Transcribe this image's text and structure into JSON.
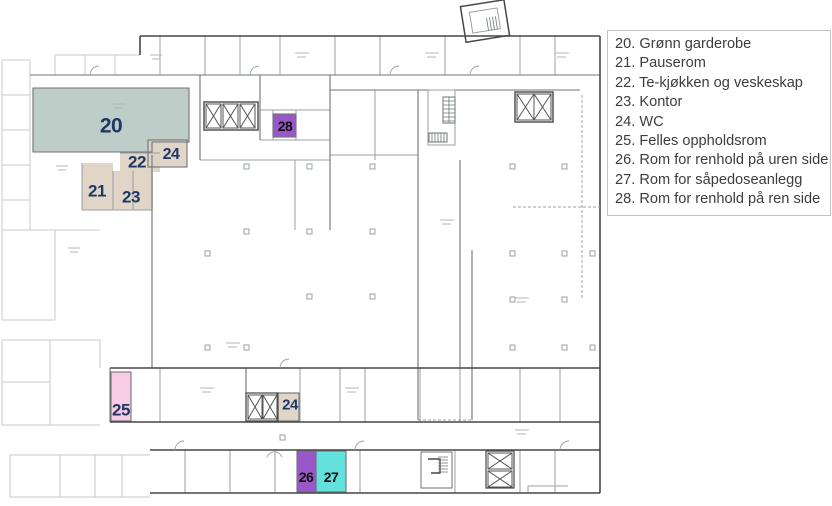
{
  "legend": {
    "items": [
      "20. Grønn garderobe",
      "21. Pauserom",
      "22. Te-kjøkken og veskeskap",
      "23. Kontor",
      "24. WC",
      "25. Felles oppholdsrom",
      "26. Rom for renhold på uren side",
      "27. Rom for såpedoseanlegg",
      "28. Rom for renhold på ren side"
    ]
  },
  "rooms": [
    {
      "number": "20",
      "name": "Grønn garderobe",
      "fill": "#b9c9c2",
      "text": "#1f3864"
    },
    {
      "number": "21",
      "name": "Pauserom",
      "fill": "#ddd1c2",
      "text": "#1f3864"
    },
    {
      "number": "22",
      "name": "Te-kjøkken og veskeskap",
      "fill": "#ddd1c2",
      "text": "#1f3864"
    },
    {
      "number": "23",
      "name": "Kontor",
      "fill": "#ddd1c2",
      "text": "#1f3864"
    },
    {
      "number": "24",
      "name": "WC",
      "fill": "#ddd1c2",
      "text": "#1f3864"
    },
    {
      "number": "24",
      "name": "WC",
      "fill": "#ddd1c2",
      "text": "#1f3864"
    },
    {
      "number": "25",
      "name": "Felles oppholdsrom",
      "fill": "#f8c8e4",
      "text": "#1f3864"
    },
    {
      "number": "26",
      "name": "Rom for renhold på uren side",
      "fill": "#9a57c8",
      "text": "#0d0d0d"
    },
    {
      "number": "27",
      "name": "Rom for såpedoseanlegg",
      "fill": "#63e1dd",
      "text": "#0d0d0d"
    },
    {
      "number": "28",
      "name": "Rom for renhold på ren side",
      "fill": "#9a57c8",
      "text": "#0d0d0d"
    }
  ]
}
